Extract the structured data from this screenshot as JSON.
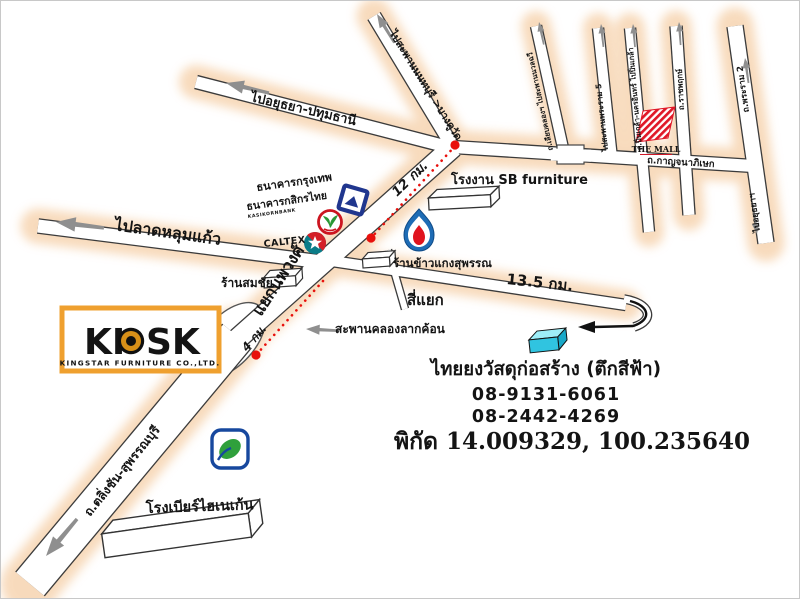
{
  "map_title": "KIOSK Kingstar Furniture location map",
  "roads": {
    "to_ayutthaya": "ไปอยุธยา-ปทุมธานี",
    "to_lat_lum_kaeo": "ไปลาดหลุมแก้ว",
    "to_nonthaburi_bridge": "ไปสะพานนนทบุรี >บางคูวัด",
    "nopphawong_junction": "แยกนพวงศ์",
    "kanchanaphisek": "ถ.กาญจนาภิเษก",
    "talingchan_suphanburi": "ถ.ตลิ่งชัน-สุพรรณบุรี",
    "v1": "ถ.เลียบคลองฯ ไปสะพานนวลฉวี",
    "v2": "ไปสะพานพระราม 5",
    "v3": "ถ.ปิ่นเกล้า-นครอินทร์ ไปปิ่นเกล้า",
    "v4": "ถ.ราชพฤกษ์",
    "v5_upper": "ถ.พระราม 2",
    "v5_lower": "ไปอยุธยาฯ",
    "si_yaek": "สี่แยก",
    "lak_khon_bridge": "สะพานคลองลากค้อน"
  },
  "places": {
    "bangkok_bank": "ธนาคารกรุงเทพ",
    "kasikorn_bank": "ธนาคารกสิกรไทย",
    "kasikorn_sub": "KASIKORNBANK",
    "caltex": "CALTEX",
    "sb_factory": "โรงงาน SB furniture",
    "somchai_shop": "ร้านสมชัย",
    "rice_shop": "ร้านข้าวแกงสุพรรณ",
    "heineken_brewery": "โรงเบียร์ไฮเนเก้น",
    "the_mall": "THE MALL"
  },
  "distances": {
    "d12": "12 กม.",
    "d4": "4 กม.",
    "d135": "13.5 กม."
  },
  "destination": {
    "name": "ไทยยงวัสดุก่อสร้าง (ตึกสีฟ้า)",
    "phone1": "08-9131-6061",
    "phone2": "08-2442-4269",
    "coordinates": "พิกัด 14.009329, 100.235640"
  },
  "kiosk_logo": {
    "text_left": "KI",
    "text_right": "SK",
    "company": "KINGSTAR FURNITURE CO.,LTD."
  },
  "colors": {
    "road_glow": "#f2bd86",
    "route_red": "#e8100c",
    "coord_red": "#cc1212",
    "building_cyan_top": "#9deef8",
    "building_cyan_front": "#30c4e0",
    "kiosk_orange": "#efa02f",
    "mall_red": "#e01828",
    "bangkok_bank_blue": "#20368e",
    "kasikorn_green": "#2a9835",
    "caltex_teal": "#0b7c88",
    "ptt_blue": "#1e6cb5",
    "bangchak_blue": "#17489e"
  }
}
